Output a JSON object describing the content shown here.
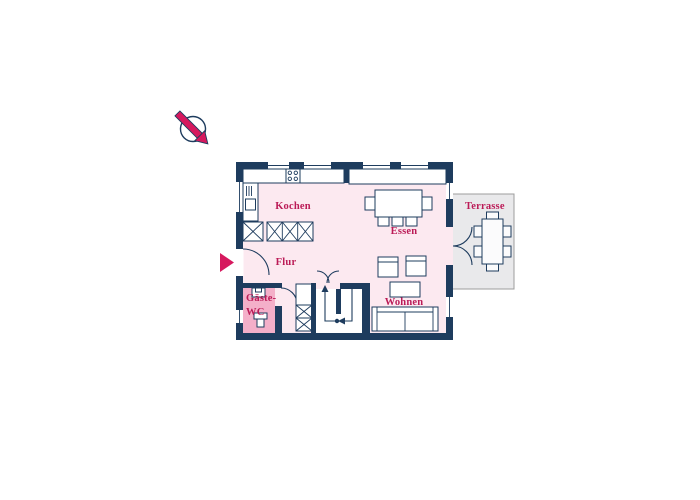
{
  "icons": {
    "north_arrow": "north-arrow-icon",
    "entrance_arrow": "entrance-arrow-icon"
  },
  "colors": {
    "wall": "#1e3c5e",
    "floor": "#fce9f0",
    "wc_floor": "#f4afc9",
    "accent": "#d6195e",
    "room_label": "#bb1b57",
    "terrace_floor": "#e9e9eb",
    "terrace_border": "#9d9d9d",
    "background": "#ffffff"
  },
  "rooms": {
    "kochen": {
      "label": "Kochen"
    },
    "essen": {
      "label": "Essen"
    },
    "flur": {
      "label": "Flur"
    },
    "gaeste_wc": {
      "label_line1": "Gäste-",
      "label_line2": "WC"
    },
    "wohnen": {
      "label": "Wohnen"
    },
    "terrasse": {
      "label": "Terrasse"
    }
  }
}
